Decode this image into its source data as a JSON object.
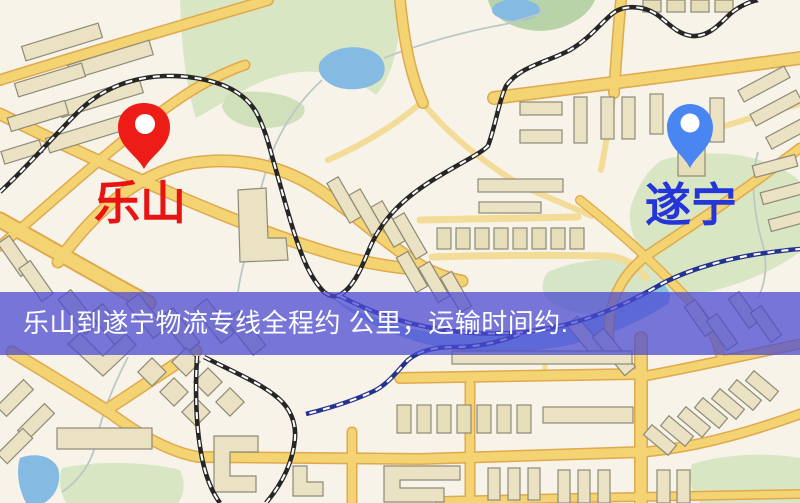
{
  "banner": {
    "text": "乐山到遂宁物流专线全程约  公里，运输时间约."
  },
  "labels": {
    "leshan": "乐山",
    "suining": "遂宁"
  },
  "markers": {
    "leshan": "map-pin-red",
    "suining": "map-pin-blue"
  },
  "colors": {
    "background": "#f7f3e9",
    "road": "#f4d372",
    "road_casing": "#dfa94e",
    "park": "#d9e6c4",
    "water": "#85bbe2",
    "building": "#eae2c3",
    "railway": "#262626",
    "railway_blue": "#25338f",
    "banner": "#4a4ad2",
    "banner_text": "#ffffff",
    "leshan_label": "#e81414",
    "suining_label": "#2436d8",
    "leshan_pin": "#ee1c16",
    "suining_pin": "#4a86f2"
  }
}
